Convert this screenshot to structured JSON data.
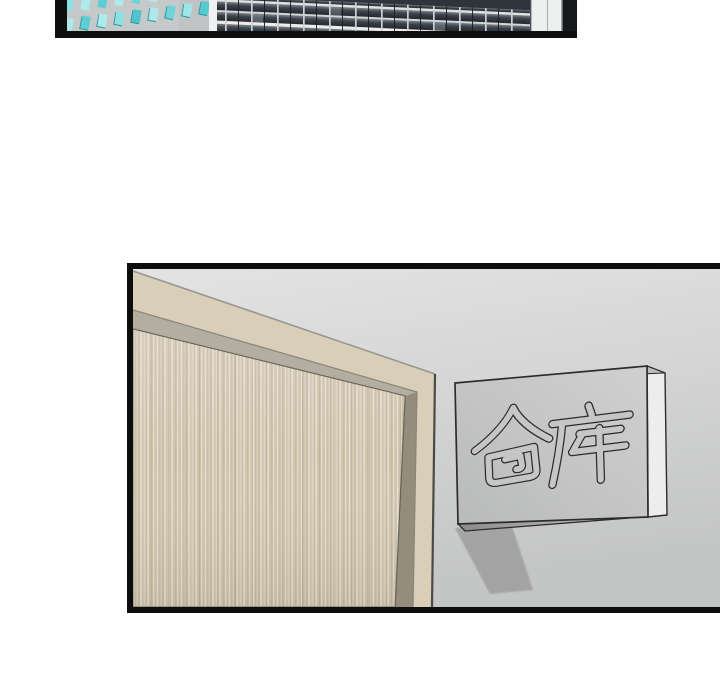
{
  "page": {
    "type": "webtoon-comic-page",
    "background_color": "#ffffff",
    "panel_border_color": "#0f0f0f"
  },
  "panels": {
    "top": {
      "name": "city-buildings-panel",
      "description": "cropped panel: high-rise facades seen from a low angle",
      "left_building": {
        "facade_color": "#c6c9c9",
        "window_color": "#aee9ec",
        "window_shade_color": "#2f9aa4",
        "corner_highlight_color": "#eef1f1"
      },
      "right_building": {
        "facade_color": "#2f343a",
        "floor_band_color": "#e9e9e9",
        "thin_band_color": "#d4d6d6",
        "mullion_color": "#ccd0d0",
        "end_column_color": "#eef0f0",
        "dark_edge_color": "#17191b"
      }
    },
    "bottom": {
      "name": "warehouse-door-panel",
      "description": "interior wall with wooden door in a frame and a wall-mounted sign",
      "wall_color_top": "#e3e3e3",
      "wall_color_bottom": "#c4c5c5",
      "door": {
        "frame_color": "#d9cfb8",
        "bevel_top_color": "#b2aea1",
        "bevel_side_color": "#958d7b",
        "wood_base_color": "#d6ccba"
      },
      "sign": {
        "text": "仓库",
        "face_color": "#c6c7c7",
        "side_color": "#ededed",
        "top_face_color": "#bdbdbd",
        "outline_color": "#2c2c2c",
        "shadow_color": "#a0a0a0"
      }
    }
  }
}
